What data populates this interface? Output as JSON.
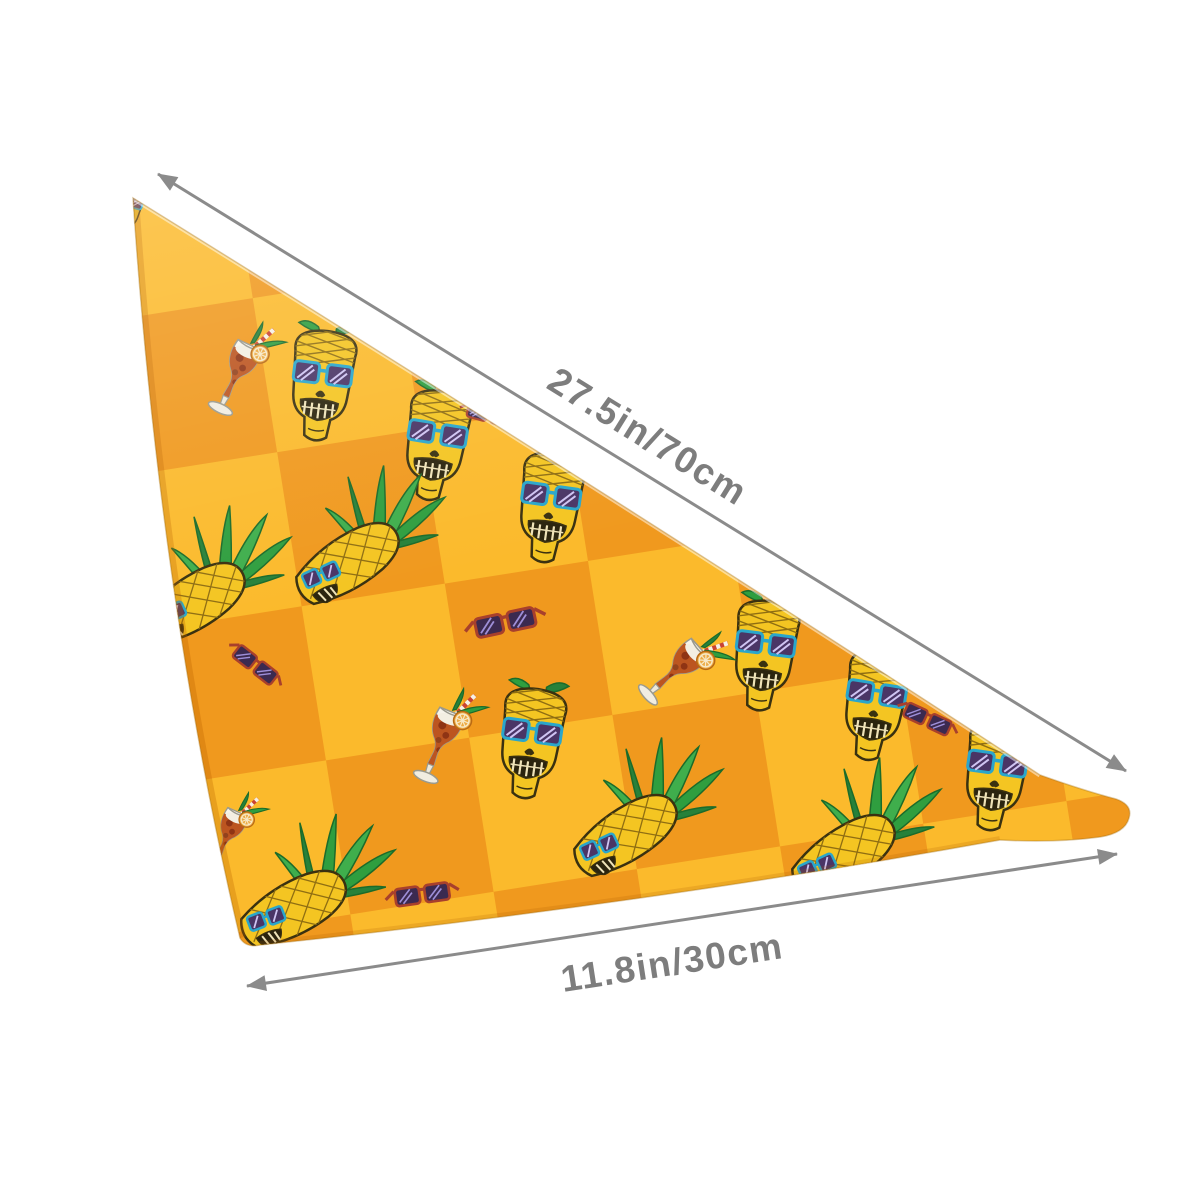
{
  "image": {
    "type": "product-dimension-mockup",
    "product": "triangular pet bandana / kerchief with pineapple skull pattern",
    "background": "#FFFFFF"
  },
  "dimensions": {
    "hypotenuse": "27.5in/70cm",
    "base": "11.8in/30cm"
  },
  "colors": {
    "fabric_light": "#FBBA2C",
    "fabric_dark": "#F0991E",
    "arrow_gray": "#8B8B8B",
    "label_gray": "#7D7D7D",
    "pineapple_yellow": "#F4C522",
    "outline_dark": "#3A3110",
    "leaf_green": "#2F9E3F",
    "leaf_green_dark": "#27813A",
    "sunglasses_teal": "#2AA6CB",
    "lens_purple": "#4A3566",
    "sunglasses_red_frame": "#A8402C",
    "cocktail_drink": "#BC5520",
    "orange_slice": "#ECAB45"
  },
  "motifs": [
    {
      "name": "pineapple-skull-head",
      "description": "skull with pineapple-textured cranium wearing teal sunglasses"
    },
    {
      "name": "pineapple-with-skull-face",
      "description": "diagonal pineapple with leafy crown and sunglasses skull face"
    },
    {
      "name": "tropical-cocktail",
      "description": "hurricane glass cocktail with striped straw, leaves and orange slice"
    },
    {
      "name": "sunglasses",
      "description": "red-framed dark sunglasses"
    }
  ]
}
